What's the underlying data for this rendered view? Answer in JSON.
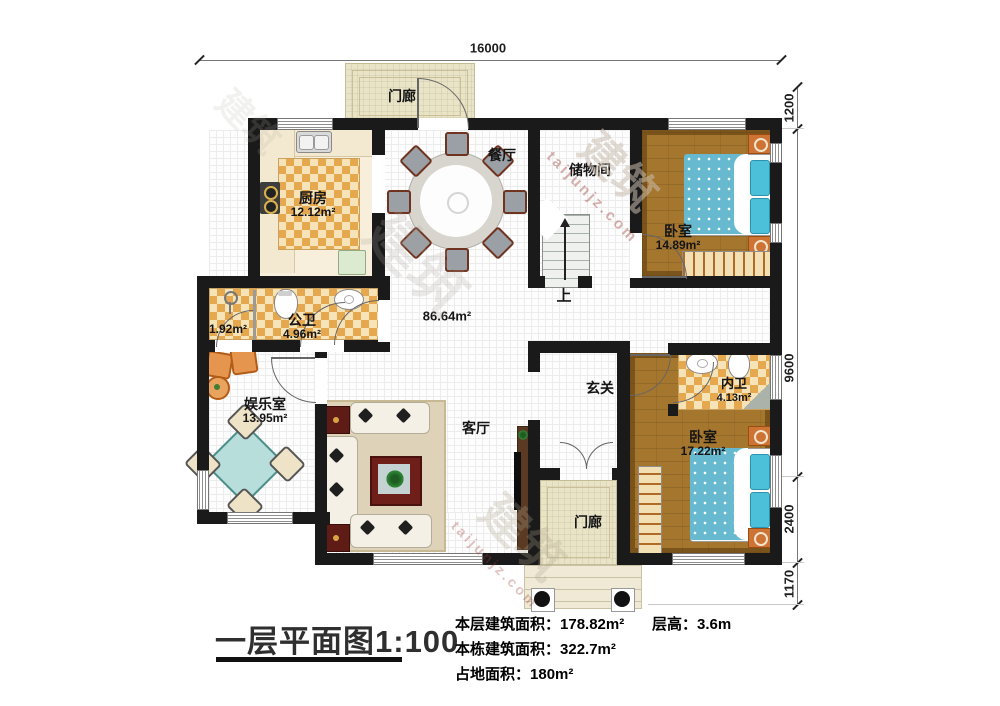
{
  "title_block": {
    "title": "一层平面图1:100",
    "stats": [
      {
        "label": "本层建筑面积：",
        "value": "178.82m²"
      },
      {
        "label": "本栋建筑面积：",
        "value": "322.7m²"
      },
      {
        "label": "占地面积：",
        "value": "180m²"
      }
    ],
    "floor_height": {
      "label": "层高：",
      "value": "3.6m"
    }
  },
  "dimensions": {
    "top": "16000",
    "right": [
      "1200",
      "9600",
      "2400",
      "1170"
    ]
  },
  "rooms": {
    "porch_top": {
      "name": "门廊"
    },
    "kitchen": {
      "name": "厨房",
      "area": "12.12m²"
    },
    "dining": {
      "name": "餐厅"
    },
    "storage": {
      "name": "储物间"
    },
    "bedroom_top": {
      "name": "卧室",
      "area": "14.89m²"
    },
    "public_bath": {
      "name": "公卫",
      "area": "4.96m²"
    },
    "shower": {
      "area": "1.92m²"
    },
    "hall": {
      "area": "86.64m²"
    },
    "entertainment": {
      "name": "娱乐室",
      "area": "13.95m²"
    },
    "living": {
      "name": "客厅"
    },
    "foyer": {
      "name": "玄关"
    },
    "master_bath": {
      "name": "内卫",
      "area": "4.13m²"
    },
    "bedroom_bottom": {
      "name": "卧室",
      "area": "17.22m²"
    },
    "porch_bottom": {
      "name": "门廊"
    },
    "stairs": {
      "direction": "上"
    }
  },
  "watermark": {
    "brand": "建筑",
    "site": "taijunjz.com"
  },
  "colors": {
    "wall": "#1a1a1a",
    "wood_floor": "#a5762e",
    "tile_orange": "#e5a84e",
    "tile_cream": "#f6e3b8",
    "bed_blue": "#66b9cf",
    "porch_beige": "#e9e4c6"
  }
}
